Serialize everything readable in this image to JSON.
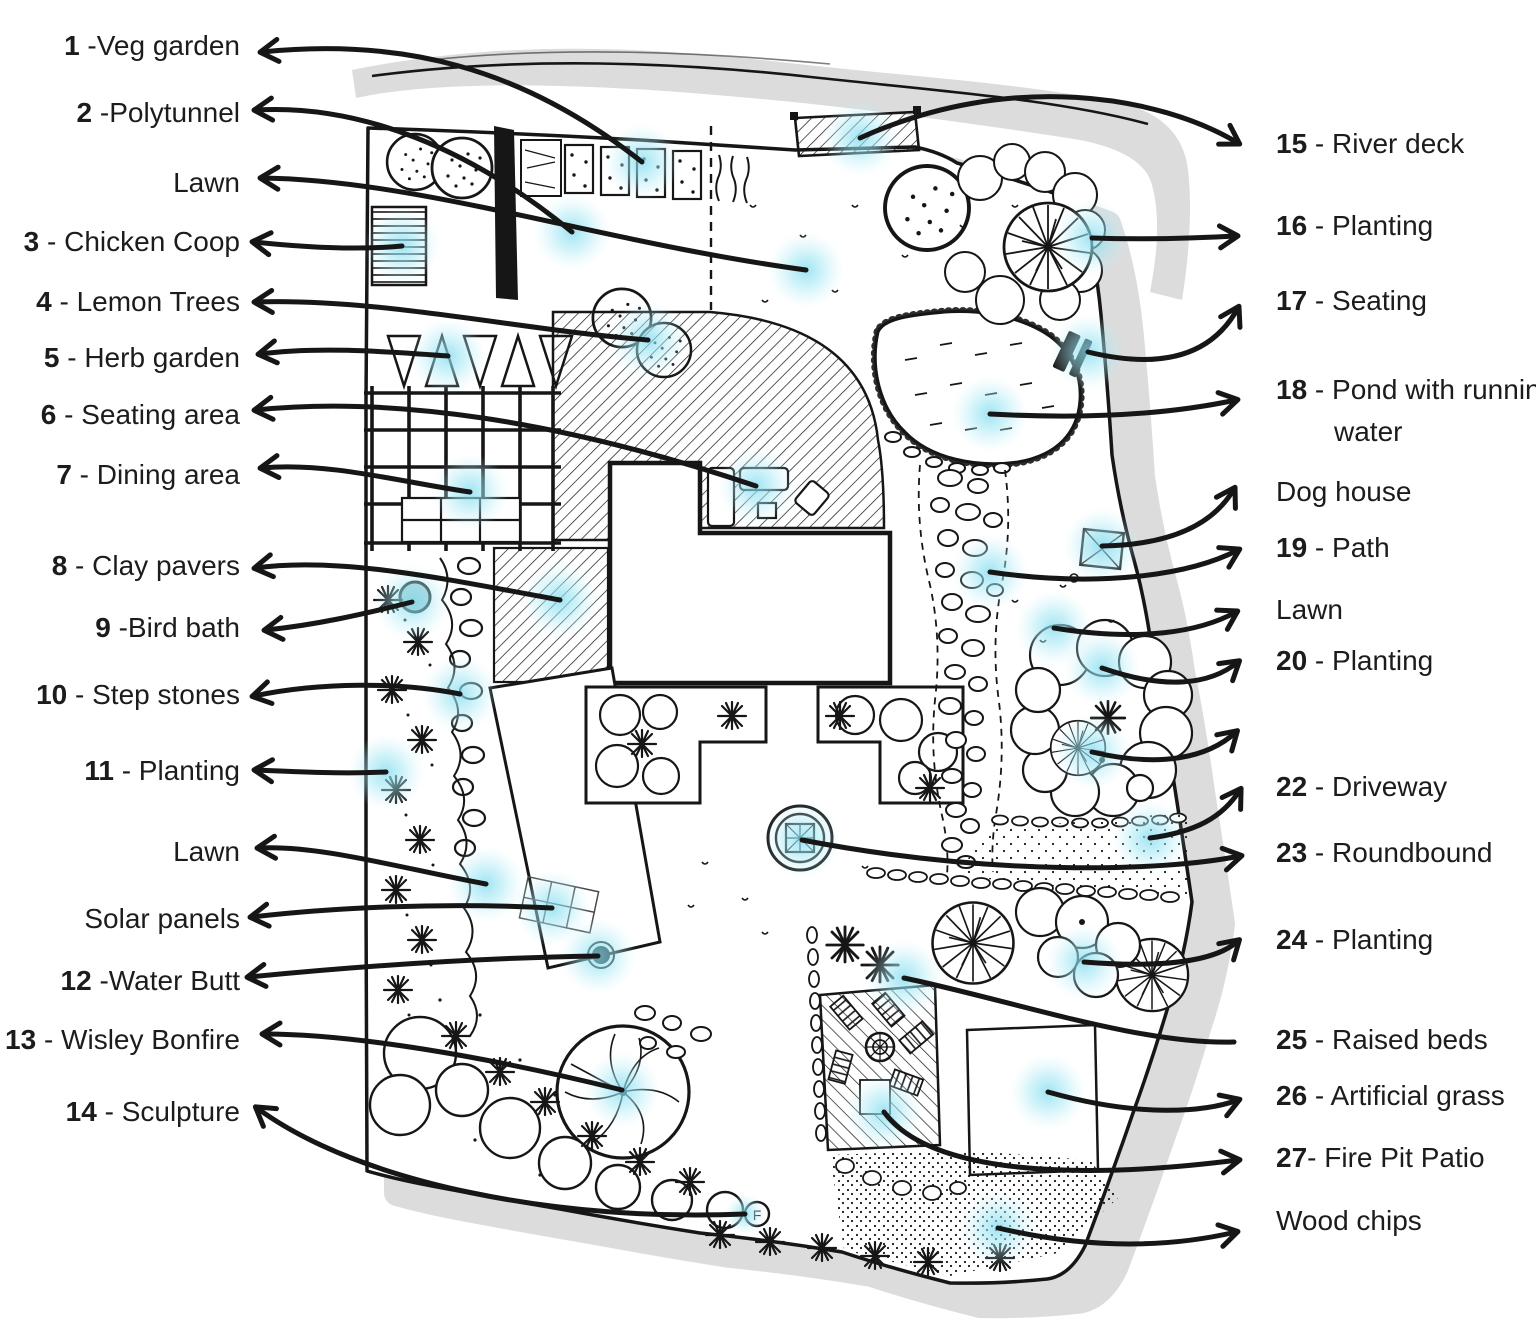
{
  "title": "Garden design plan with numbered legend",
  "colors": {
    "ink": "#161616",
    "label_text": "#1c1c1c",
    "glow": "#7fd9ee",
    "shadow": "#dcdcdc",
    "water": "#a9cdd1",
    "paper": "#ffffff"
  },
  "plan": {
    "sculpture_letter": "F"
  },
  "legend_left_anchor_x": 240,
  "legend_right_anchor_x": 1276,
  "callouts": [
    {
      "id": "veg-garden",
      "side": "left",
      "b": "1",
      "r": " -Veg garden",
      "y": 46,
      "p": [
        642,
        162,
        520,
        66,
        400,
        38,
        262,
        52
      ]
    },
    {
      "id": "polytunnel",
      "side": "left",
      "b": "2",
      "r": " -Polytunnel",
      "y": 113,
      "p": [
        572,
        232,
        470,
        148,
        360,
        104,
        256,
        110
      ]
    },
    {
      "id": "lawn-top",
      "side": "left",
      "b": "",
      "r": "Lawn",
      "y": 183,
      "p": [
        806,
        270,
        600,
        242,
        420,
        180,
        262,
        178
      ]
    },
    {
      "id": "chicken-coop",
      "side": "left",
      "b": "3",
      "r": " - Chicken Coop",
      "y": 242,
      "p": [
        402,
        246,
        360,
        250,
        310,
        248,
        254,
        242
      ]
    },
    {
      "id": "lemon-trees",
      "side": "left",
      "b": "4",
      "r": " - Lemon Trees",
      "y": 302,
      "p": [
        648,
        340,
        520,
        330,
        380,
        298,
        256,
        302
      ]
    },
    {
      "id": "herb-garden",
      "side": "left",
      "b": "5",
      "r": " - Herb garden",
      "y": 358,
      "p": [
        448,
        356,
        390,
        352,
        320,
        346,
        260,
        354
      ]
    },
    {
      "id": "seating-area",
      "side": "left",
      "b": "6",
      "r": " - Seating area",
      "y": 415,
      "p": [
        756,
        486,
        560,
        420,
        390,
        396,
        256,
        410
      ]
    },
    {
      "id": "dining-area",
      "side": "left",
      "b": "7",
      "r": " -  Dining area",
      "y": 475,
      "p": [
        470,
        492,
        400,
        482,
        330,
        462,
        262,
        468
      ]
    },
    {
      "id": "clay-pavers",
      "side": "left",
      "b": "8",
      "r": " -  Clay pavers",
      "y": 566,
      "p": [
        560,
        600,
        450,
        580,
        340,
        556,
        256,
        568
      ]
    },
    {
      "id": "bird-bath",
      "side": "left",
      "b": "9",
      "r": " -Bird bath",
      "y": 628,
      "p": [
        412,
        602,
        360,
        615,
        315,
        625,
        266,
        630
      ]
    },
    {
      "id": "step-stones",
      "side": "left",
      "b": "10",
      "r": " - Step stones",
      "y": 695,
      "p": [
        460,
        694,
        400,
        682,
        320,
        682,
        254,
        696
      ]
    },
    {
      "id": "planting-11",
      "side": "left",
      "b": "11",
      "r": " - Planting",
      "y": 771,
      "p": [
        386,
        772,
        345,
        774,
        300,
        772,
        256,
        770
      ]
    },
    {
      "id": "lawn-mid",
      "side": "left",
      "b": "",
      "r": "Lawn",
      "y": 852,
      "p": [
        486,
        884,
        400,
        868,
        320,
        845,
        259,
        848
      ]
    },
    {
      "id": "solar-panels",
      "side": "left",
      "b": "",
      "r": "Solar panels",
      "y": 919,
      "p": [
        552,
        908,
        440,
        902,
        330,
        908,
        252,
        917
      ]
    },
    {
      "id": "water-butt",
      "side": "left",
      "b": "12",
      "r": " -Water Butt",
      "y": 981,
      "p": [
        598,
        956,
        470,
        958,
        340,
        968,
        249,
        977
      ]
    },
    {
      "id": "wisley-bonfire",
      "side": "left",
      "b": "13",
      "r": " - Wisley Bonfire",
      "y": 1040,
      "p": [
        622,
        1090,
        480,
        1055,
        350,
        1034,
        264,
        1034
      ]
    },
    {
      "id": "sculpture",
      "side": "left",
      "b": "14",
      "r": " - Sculpture",
      "y": 1112,
      "gr": 20,
      "p": [
        745,
        1214,
        560,
        1222,
        360,
        1184,
        257,
        1108
      ]
    },
    {
      "id": "river-deck",
      "side": "right",
      "b": "15",
      "r": " - River deck",
      "y": 144,
      "p": [
        860,
        138,
        1010,
        70,
        1160,
        96,
        1238,
        143
      ]
    },
    {
      "id": "planting-16",
      "side": "right",
      "b": "16",
      "r": " - Planting",
      "y": 226,
      "p": [
        1092,
        238,
        1150,
        240,
        1200,
        238,
        1236,
        236
      ]
    },
    {
      "id": "seating-17",
      "side": "right",
      "b": "17",
      "r": " - Seating",
      "y": 301,
      "p": [
        1088,
        352,
        1170,
        372,
        1215,
        350,
        1238,
        308
      ]
    },
    {
      "id": "pond",
      "side": "right",
      "b": "18",
      "r": " - Pond with running water",
      "y": 389,
      "wrap": true,
      "p": [
        990,
        414,
        1100,
        420,
        1180,
        412,
        1236,
        400
      ]
    },
    {
      "id": "dog-house",
      "side": "right",
      "b": "",
      "r": "Dog house",
      "y": 492,
      "p": [
        1102,
        546,
        1160,
        545,
        1210,
        530,
        1234,
        489
      ]
    },
    {
      "id": "path-19",
      "side": "right",
      "b": "19",
      "r": " - Path",
      "y": 548,
      "p": [
        990,
        572,
        1100,
        588,
        1190,
        575,
        1238,
        550
      ]
    },
    {
      "id": "lawn-right",
      "side": "right",
      "b": "",
      "r": "Lawn",
      "y": 610,
      "p": [
        1054,
        628,
        1140,
        642,
        1200,
        632,
        1236,
        612
      ]
    },
    {
      "id": "planting-20",
      "side": "right",
      "b": "20",
      "r": " - Planting",
      "y": 661,
      "p": [
        1102,
        668,
        1165,
        690,
        1210,
        685,
        1238,
        662
      ]
    },
    {
      "id": "unlabeled-21",
      "side": "right",
      "b": "",
      "r": "",
      "y": 732,
      "p": [
        1092,
        752,
        1160,
        768,
        1208,
        758,
        1236,
        732
      ]
    },
    {
      "id": "driveway",
      "side": "right",
      "b": "22",
      "r": " - Driveway",
      "y": 787,
      "p": [
        1150,
        838,
        1195,
        832,
        1222,
        818,
        1240,
        790
      ]
    },
    {
      "id": "roundbound",
      "side": "right",
      "b": "23",
      "r": " - Roundbound",
      "y": 853,
      "p": [
        802,
        840,
        990,
        876,
        1160,
        872,
        1240,
        856
      ]
    },
    {
      "id": "planting-24",
      "side": "right",
      "b": "24",
      "r": " - Planting",
      "y": 940,
      "p": [
        1084,
        962,
        1160,
        968,
        1215,
        962,
        1238,
        941
      ]
    },
    {
      "id": "raised-beds",
      "side": "right",
      "b": "25",
      "r": " - Raised beds",
      "y": 1040,
      "head": false,
      "p": [
        904,
        978,
        1010,
        1000,
        1140,
        1045,
        1234,
        1042
      ]
    },
    {
      "id": "artificial-grass",
      "side": "right",
      "b": "26",
      "r": " - Artificial grass",
      "y": 1096,
      "p": [
        1048,
        1092,
        1140,
        1118,
        1205,
        1112,
        1238,
        1100
      ]
    },
    {
      "id": "fire-pit-patio",
      "side": "right",
      "b": "27",
      "r": "- Fire Pit Patio",
      "y": 1158,
      "p": [
        884,
        1112,
        930,
        1175,
        1080,
        1180,
        1238,
        1160
      ]
    },
    {
      "id": "wood-chips",
      "side": "right",
      "b": "",
      "r": "Wood chips",
      "y": 1221,
      "p": [
        998,
        1228,
        1100,
        1252,
        1180,
        1245,
        1236,
        1232
      ]
    }
  ]
}
